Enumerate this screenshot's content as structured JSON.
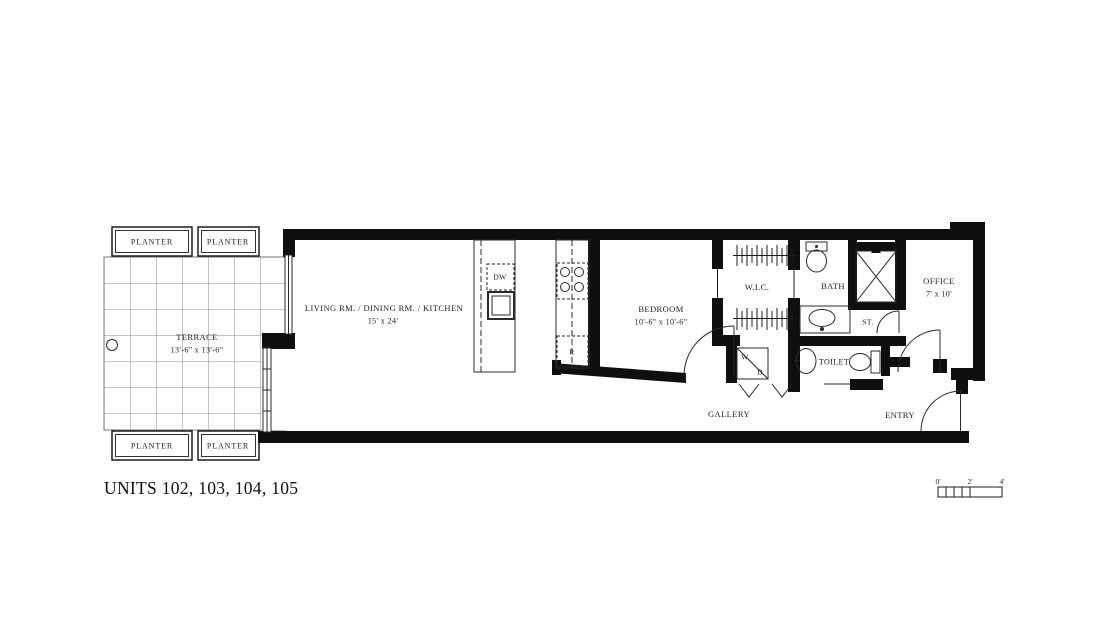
{
  "drawing_title": "UNITS 102, 103, 104, 105",
  "rooms": {
    "terrace": {
      "name": "TERRACE",
      "dims": "13'-6\" x 13'-6\""
    },
    "living": {
      "name": "LIVING RM. / DINING RM. / KITCHEN",
      "dims": "15' x 24'"
    },
    "bedroom": {
      "name": "BEDROOM",
      "dims": "10'-6\" x 10'-6\""
    },
    "wic": {
      "name": "W.I.C."
    },
    "bath": {
      "name": "BATH"
    },
    "office": {
      "name": "OFFICE",
      "dims": "7' x 10'"
    },
    "storage": {
      "name": "ST."
    },
    "toilet": {
      "name": "TOILET"
    },
    "gallery": {
      "name": "GALLERY"
    },
    "entry": {
      "name": "ENTRY"
    }
  },
  "fixtures": {
    "planter": "PLANTER",
    "dishwasher": "DW",
    "refrigerator": "R",
    "washer": "W",
    "dryer": "D"
  },
  "scale_bar": {
    "tick_0": "0'",
    "tick_2": "2'",
    "tick_4": "4'"
  },
  "colors": {
    "wall": "#0f0f0f",
    "line": "#2a2a2a",
    "grid": "#6a6a6a",
    "background": "#ffffff"
  }
}
